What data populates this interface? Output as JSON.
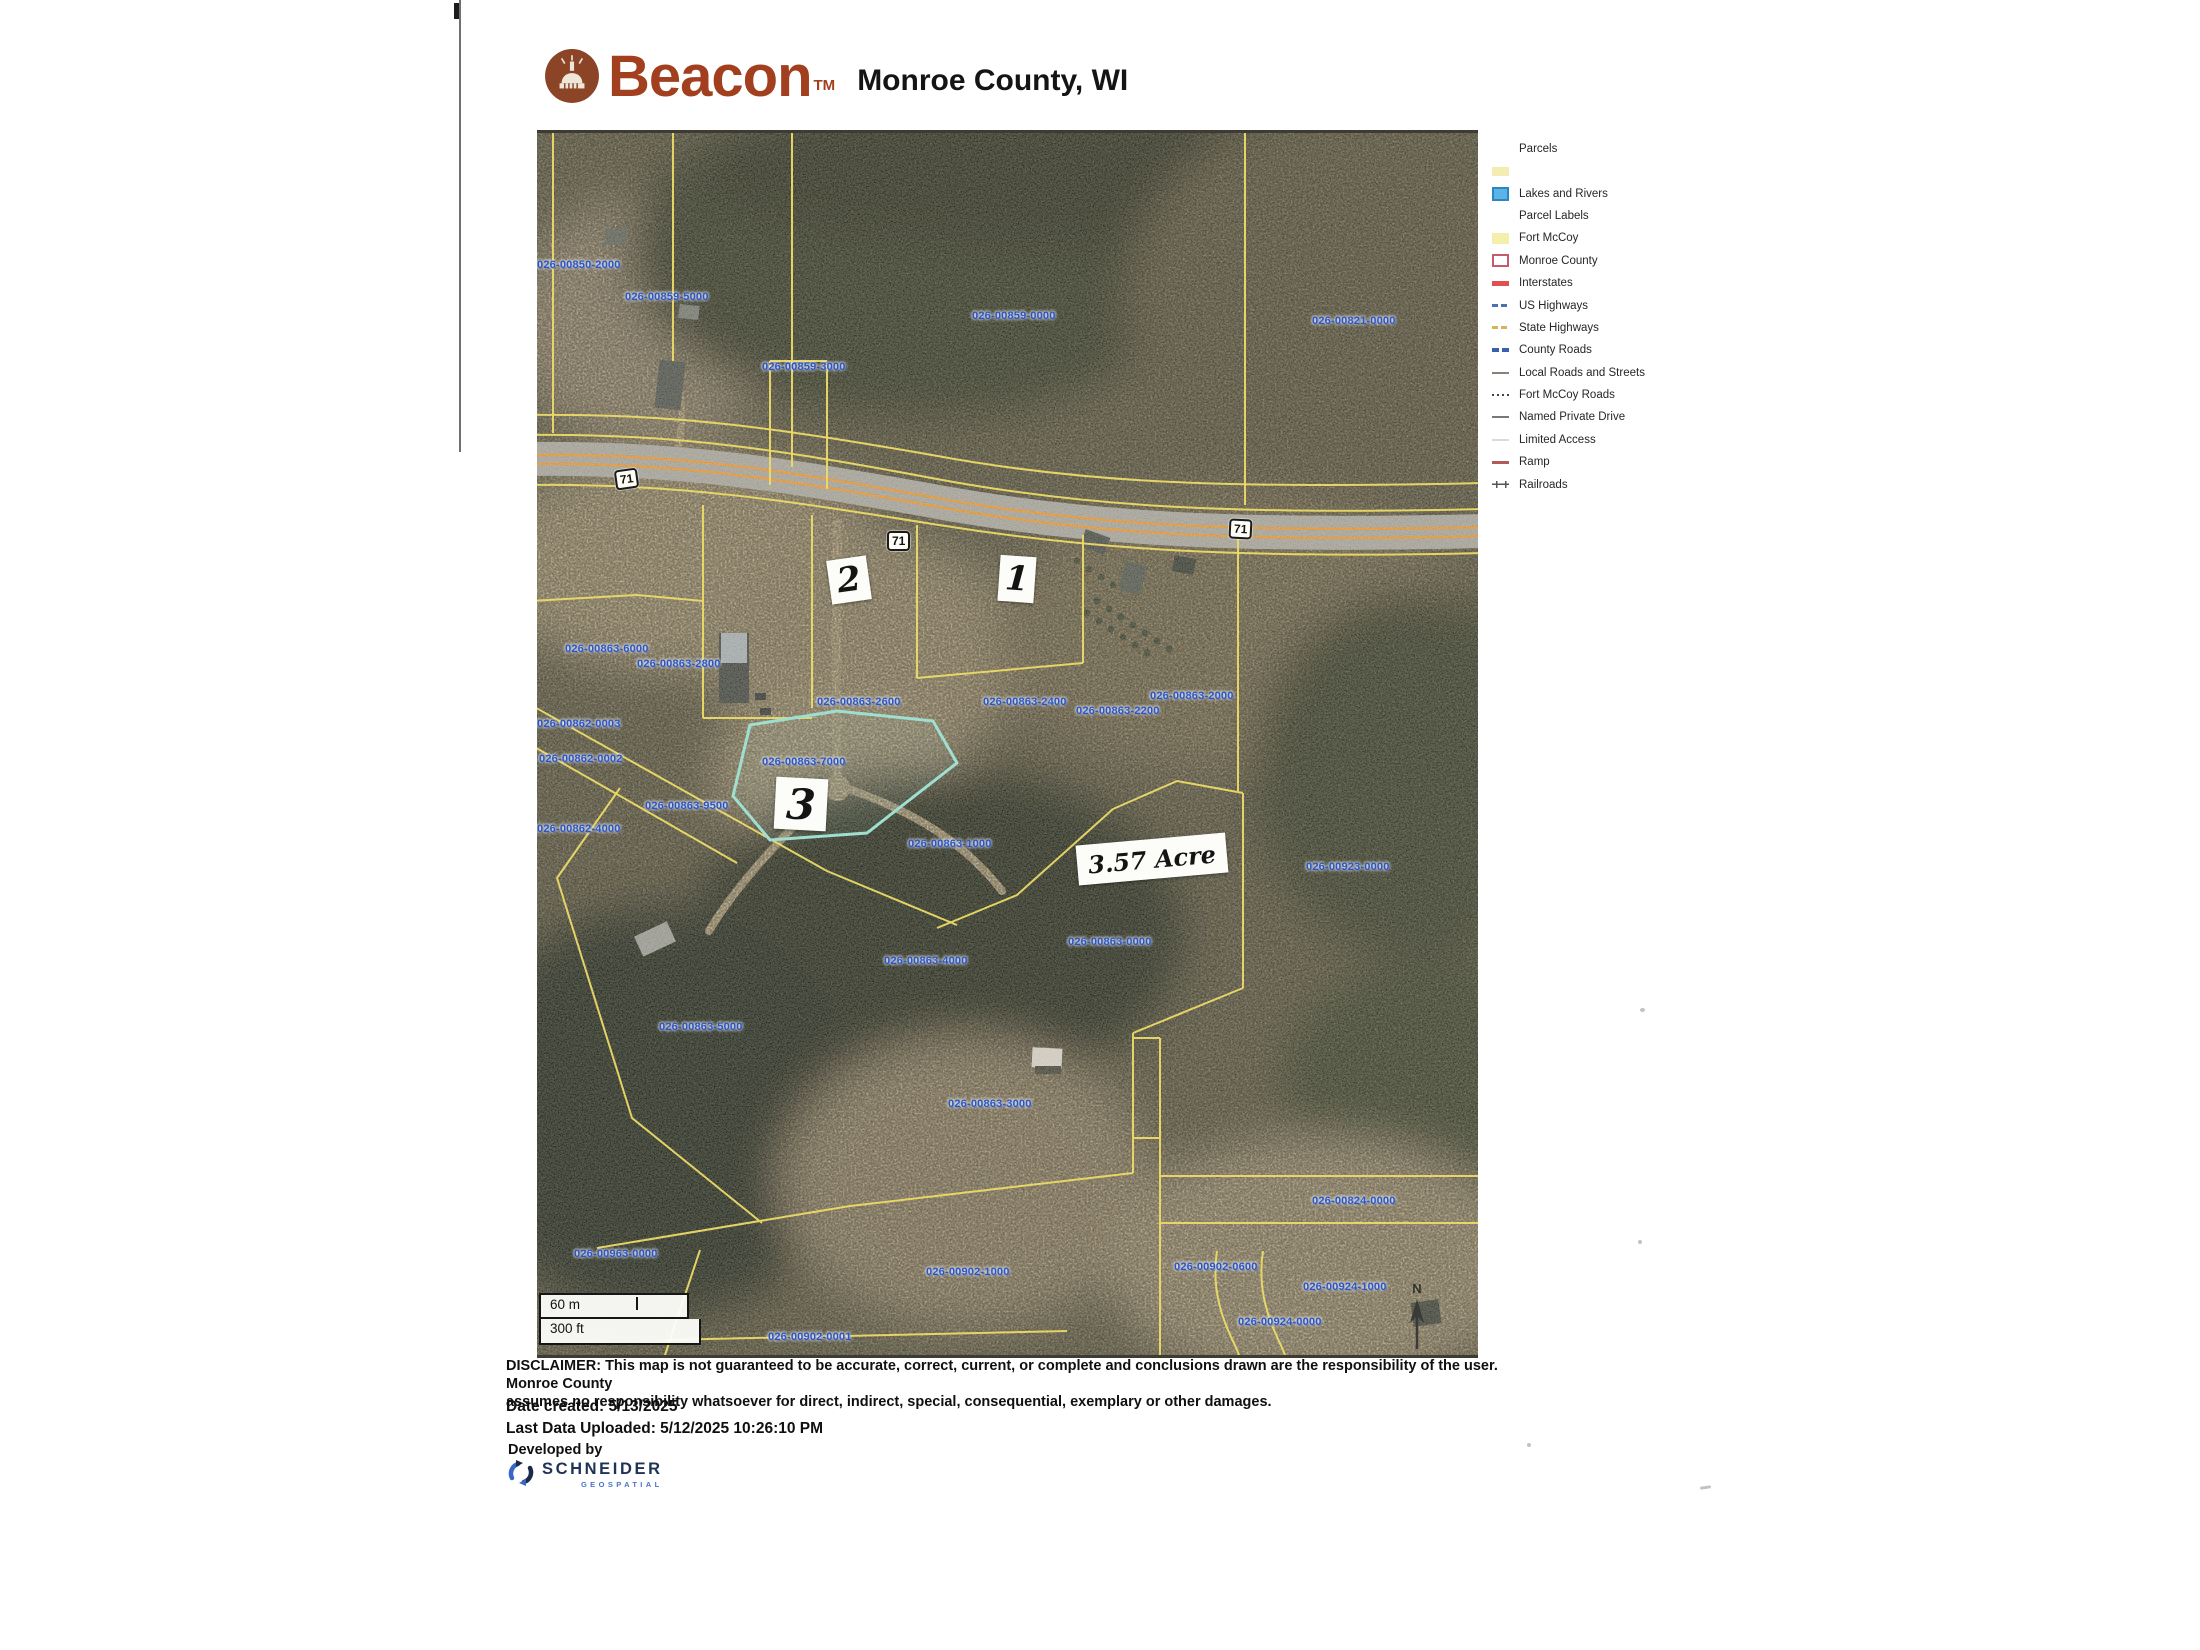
{
  "header": {
    "brand": "Beacon",
    "brand_tm": "TM",
    "title": "Monroe County, WI"
  },
  "legend": {
    "title": "Parcels",
    "items": [
      {
        "label": "Lakes and Rivers",
        "swatch": "lakes"
      },
      {
        "label": "Parcel Labels",
        "swatch": "none"
      },
      {
        "label": "Fort McCoy",
        "swatch": "fortmccoy"
      },
      {
        "label": "Monroe County",
        "swatch": "monroe"
      },
      {
        "label": "Interstates",
        "swatch": "interstates"
      },
      {
        "label": "US Highways",
        "swatch": "ushighways"
      },
      {
        "label": "State Highways",
        "swatch": "statehighways"
      },
      {
        "label": "County Roads",
        "swatch": "countyroads"
      },
      {
        "label": "Local Roads and Streets",
        "swatch": "localroads"
      },
      {
        "label": "Fort McCoy Roads",
        "swatch": "fortroads"
      },
      {
        "label": "Named Private Drive",
        "swatch": "privatedrive"
      },
      {
        "label": "Limited Access",
        "swatch": "limited"
      },
      {
        "label": "Ramp",
        "swatch": "ramp"
      },
      {
        "label": "Railroads",
        "swatch": "railroads"
      }
    ]
  },
  "map": {
    "parcel_labels": [
      {
        "text": "026-00850-2000",
        "x": 0,
        "y": 126
      },
      {
        "text": "026-00859-5000",
        "x": 88,
        "y": 158
      },
      {
        "text": "026-00859-3000",
        "x": 225,
        "y": 228
      },
      {
        "text": "026-00859-0000",
        "x": 435,
        "y": 177
      },
      {
        "text": "026-00821-0000",
        "x": 775,
        "y": 182
      },
      {
        "text": "026-00863-6000",
        "x": 28,
        "y": 510
      },
      {
        "text": "026-00863-2800",
        "x": 100,
        "y": 525
      },
      {
        "text": "026-00863-2600",
        "x": 280,
        "y": 563
      },
      {
        "text": "026-00863-2400",
        "x": 446,
        "y": 563
      },
      {
        "text": "026-00863-2200",
        "x": 539,
        "y": 572
      },
      {
        "text": "026-00863-2000",
        "x": 613,
        "y": 557
      },
      {
        "text": "026-00862-0003",
        "x": 0,
        "y": 585
      },
      {
        "text": "026-00862-0002",
        "x": 2,
        "y": 620
      },
      {
        "text": "026-00863-7000",
        "x": 225,
        "y": 623
      },
      {
        "text": "026-00863-9500",
        "x": 108,
        "y": 667
      },
      {
        "text": "026-00862-4000",
        "x": 0,
        "y": 690
      },
      {
        "text": "026-00863-1000",
        "x": 371,
        "y": 705
      },
      {
        "text": "026-00923-0000",
        "x": 769,
        "y": 728
      },
      {
        "text": "026-00863-0000",
        "x": 531,
        "y": 803
      },
      {
        "text": "026-00863-4000",
        "x": 347,
        "y": 822
      },
      {
        "text": "026-00863-5000",
        "x": 122,
        "y": 888
      },
      {
        "text": "026-00863-3000",
        "x": 411,
        "y": 965
      },
      {
        "text": "026-00824-0000",
        "x": 775,
        "y": 1062
      },
      {
        "text": "026-00963-0000",
        "x": 37,
        "y": 1115
      },
      {
        "text": "026-00902-1000",
        "x": 389,
        "y": 1133
      },
      {
        "text": "026-00902-0600",
        "x": 637,
        "y": 1128
      },
      {
        "text": "026-00924-1000",
        "x": 766,
        "y": 1148
      },
      {
        "text": "026-00924-0000",
        "x": 701,
        "y": 1183
      },
      {
        "text": "026-00902-0001",
        "x": 231,
        "y": 1198
      }
    ],
    "route_shields": [
      {
        "text": "71",
        "x": 78,
        "y": 336,
        "rot": -8
      },
      {
        "text": "71",
        "x": 350,
        "y": 398,
        "rot": 0
      },
      {
        "text": "71",
        "x": 692,
        "y": 386,
        "rot": 3
      }
    ],
    "annotations": [
      {
        "text": "2",
        "x": 292,
        "y": 425,
        "w": 40,
        "h": 44,
        "rot": -8,
        "size": 34
      },
      {
        "text": "1",
        "x": 462,
        "y": 423,
        "w": 36,
        "h": 46,
        "rot": 4,
        "size": 34
      },
      {
        "text": "3",
        "x": 238,
        "y": 645,
        "w": 52,
        "h": 52,
        "rot": 3,
        "size": 42
      },
      {
        "text": "3.57 Acre",
        "x": 540,
        "y": 706,
        "w": 150,
        "h": 40,
        "rot": -5,
        "size": 24
      }
    ],
    "scale": {
      "metric": "60 m",
      "imperial": "300 ft"
    },
    "north_label": "N"
  },
  "footer": {
    "disclaimer_line1": "DISCLAIMER: This map is not guaranteed to be accurate, correct, current, or complete and conclusions drawn are the responsibility of the user. Monroe County",
    "disclaimer_line2": "assumes no responsibility whatsoever for direct, indirect, special, consequential, exemplary or other damages.",
    "date_created": "Date created: 5/13/2025",
    "last_uploaded": "Last Data Uploaded: 5/12/2025 10:26:10 PM",
    "developed_by": "Developed by",
    "developer": "SCHNEIDER",
    "developer_sub": "GEOSPATIAL"
  },
  "colors": {
    "beacon_red": "#a23f1f",
    "parcel_line_yellow": "#e8d348",
    "label_blue": "#2a55c2",
    "highlight_teal": "#8ad8c8",
    "lakes_blue": "#5ab4e8",
    "highway_orange": "#d88c2c"
  }
}
